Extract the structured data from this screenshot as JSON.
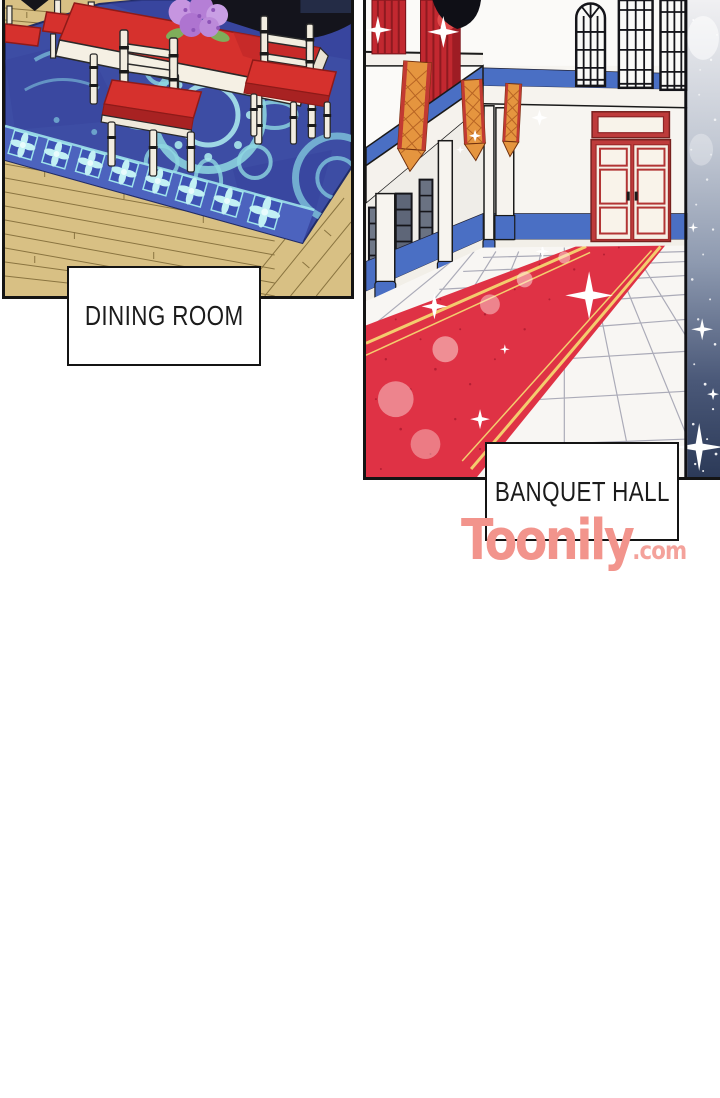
{
  "page": {
    "width": 720,
    "height": 1098,
    "background": "#FFFFFF"
  },
  "panels": {
    "dining": {
      "label": "DINING ROOM",
      "scene": "dining room with wooden floor, ornate blue carpet, white table with red runner, chairs with red cushions, purple flower bouquet"
    },
    "banquet": {
      "label": "BANQUET HALL",
      "scene": "banquet hall with white columns, hanging banners, red curtains, tall windows, red double door, sparkling red carpet on tiled floor"
    }
  },
  "watermark": {
    "brand": "Toonily",
    "suffix": ".com",
    "color": "#F2948C"
  },
  "palette": {
    "panel_border": "#141414",
    "wood_floor": "#D8C084",
    "wood_line": "#8A7440",
    "carpet_blue": "#3D4DA4",
    "carpet_border_blue": "#4C63BE",
    "carpet_motif_cyan": "#9FE0E6",
    "cushion_red": "#D6312D",
    "banquet_red_carpet": "#DF3245",
    "gold_stripe": "#F4CC6E",
    "door_red": "#BE3B3B",
    "trim_blue": "#4A6FC4",
    "banner_orange": "#E5953F",
    "drape_red": "#C22830",
    "sparkle_navy": "#2C3A58"
  }
}
